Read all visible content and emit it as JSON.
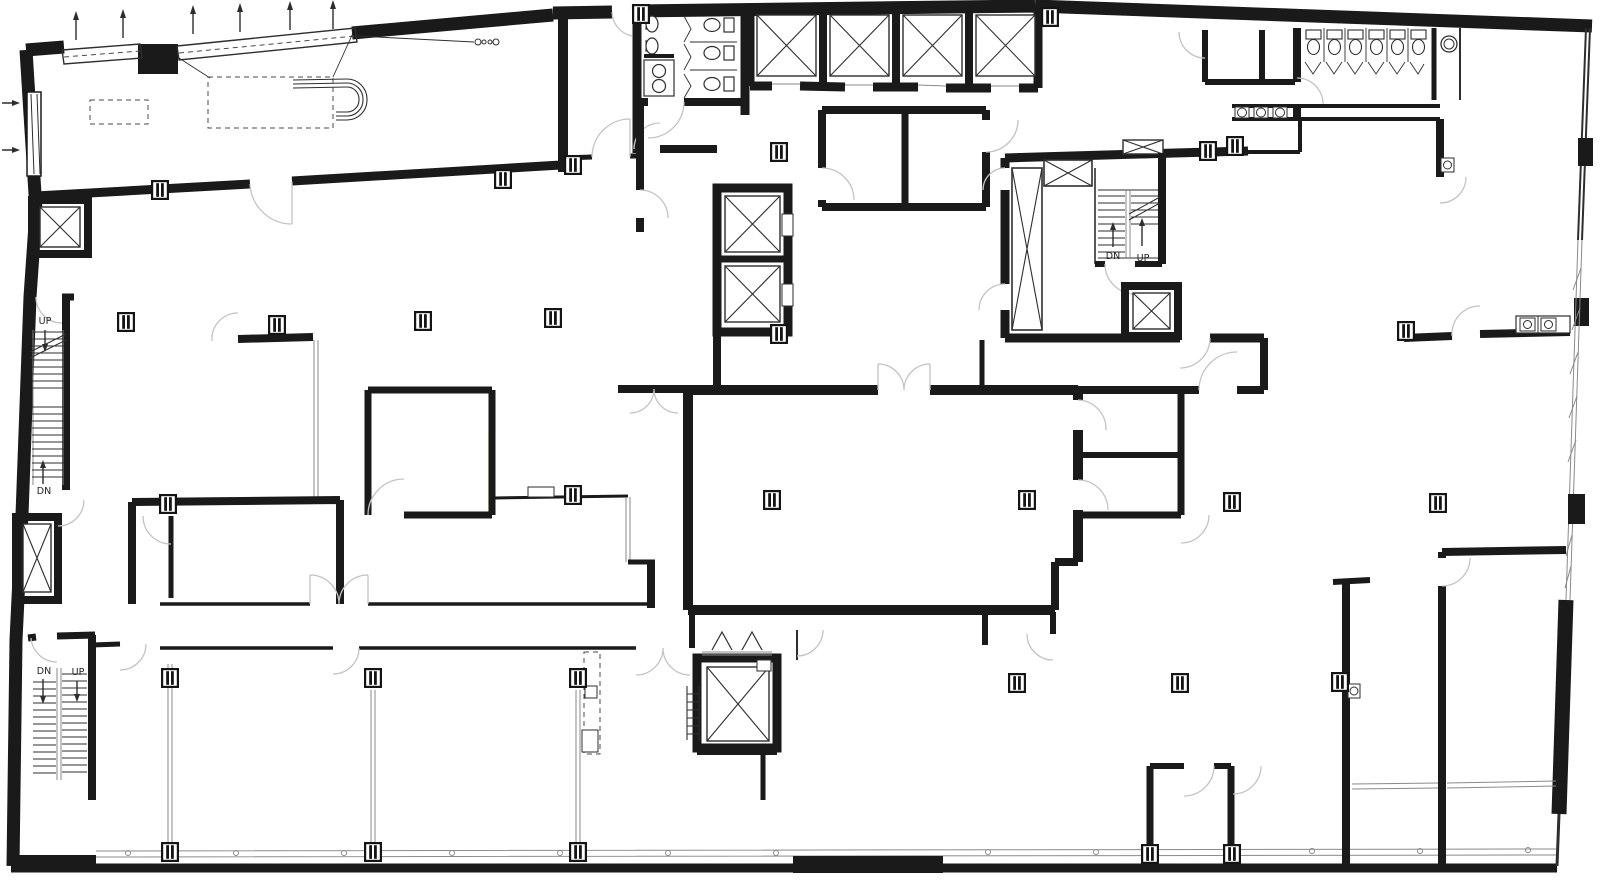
{
  "page": {
    "background": "#ffffff"
  },
  "colors": {
    "walls": "#1a1a1a",
    "thin_lines": "#2e2e2e",
    "door_swings": "#c3c3c3",
    "glazing": "#8a8a8a",
    "highlight": "#eef2a8",
    "background": "#ffffff"
  },
  "plan": {
    "type": "architectural-floor-plan",
    "labels": {
      "stair_nw_up": "UP",
      "stair_nw_dn": "DN",
      "stair_sw_dn": "DN",
      "stair_sw_up": "UP",
      "stair_core_dn": "DN",
      "stair_core_up": "UP"
    },
    "symbols": {
      "elevator_shaft": "x-box",
      "vent_shaft": "x-box-narrow",
      "stair": "parallel-treads-with-arrow",
      "column": "double-bar-square",
      "door": "quarter-circle-swing",
      "toilet": "tank-and-bowl",
      "urinal": "half-oval",
      "sink": "circle-in-square",
      "window": "double-line-with-mullions"
    },
    "counts": {
      "stairs": 3,
      "elevator_shafts": 10,
      "toilets": 9,
      "urinals": 2,
      "sinks": 8,
      "columns": 30
    }
  }
}
